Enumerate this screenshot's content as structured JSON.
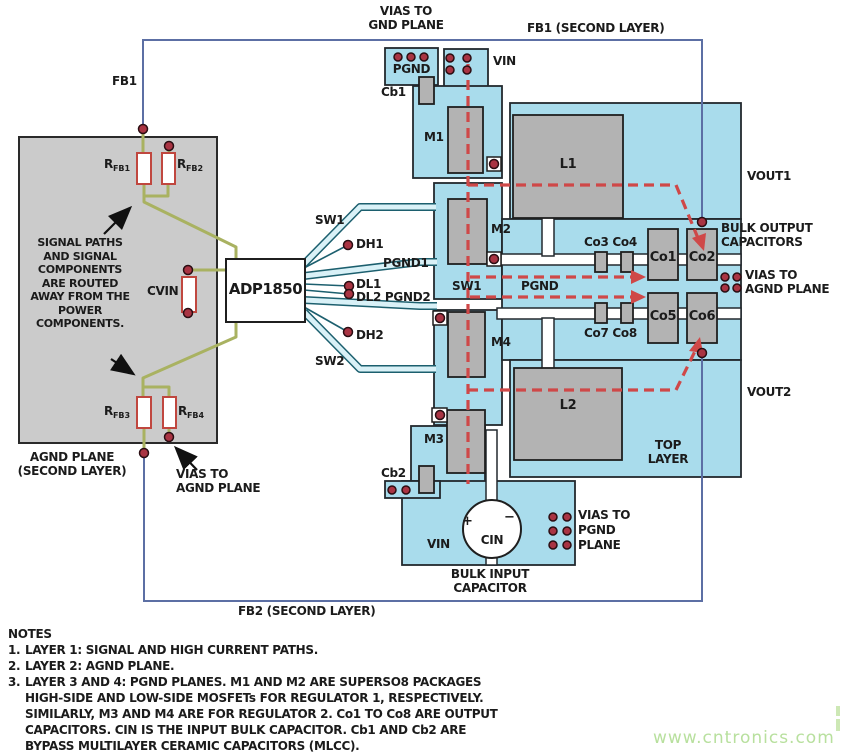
{
  "title": "ADP1850 dual buck regulator PCB layout diagram",
  "labels": {
    "vias_gnd_plane": [
      "VIAS TO",
      "GND PLANE"
    ],
    "fb1_second_layer": "FB1 (SECOND LAYER)",
    "fb1": "FB1",
    "vin_top": "VIN",
    "pgnd_pad": "PGND",
    "cb1": "Cb1",
    "m1": "M1",
    "m2": "M2",
    "m3": "M3",
    "m4": "M4",
    "l1": "L1",
    "l2": "L2",
    "sw1_pin": "SW1",
    "sw2_pin": "SW2",
    "dh1": "DH1",
    "pgnd1": "PGND1",
    "dl1": "DL1",
    "dl2_pgnd2": "DL2 PGND2",
    "dh2": "DH2",
    "chip": "ADP1850",
    "cvin": "CVIN",
    "signal_note": "SIGNAL PATHS AND SIGNAL COMPONENTS ARE ROUTED AWAY FROM THE POWER COMPONENTS.",
    "agnd_plane": [
      "AGND PLANE",
      "(SECOND LAYER)"
    ],
    "vias_agnd_left": [
      "VIAS TO",
      "AGND PLANE"
    ],
    "fb2_second_layer": "FB2 (SECOND LAYER)",
    "sw1_region": "SW1",
    "pgnd_region": "PGND",
    "co3co4": "Co3 Co4",
    "co7co8": "Co7 Co8",
    "co1": "Co1",
    "co2": "Co2",
    "co5": "Co5",
    "co6": "Co6",
    "bulk_output": [
      "BULK OUTPUT",
      "CAPACITORS"
    ],
    "vias_agnd_right": [
      "VIAS TO",
      "AGND PLANE"
    ],
    "vout1": "VOUT1",
    "vout2": "VOUT2",
    "top_layer": [
      "TOP",
      "LAYER"
    ],
    "vin_bottom": "VIN",
    "cin": "CIN",
    "cin_plus": "+",
    "cin_minus": "−",
    "bulk_input": [
      "BULK INPUT",
      "CAPACITOR"
    ],
    "vias_pgnd_plane": [
      "VIAS TO",
      "PGND",
      "PLANE"
    ],
    "cb2": "Cb2"
  },
  "resistors": {
    "rfb1": {
      "main": "R",
      "sub": "FB1"
    },
    "rfb2": {
      "main": "R",
      "sub": "FB2"
    },
    "rfb3": {
      "main": "R",
      "sub": "FB3"
    },
    "rfb4": {
      "main": "R",
      "sub": "FB4"
    }
  },
  "notes": {
    "title": "NOTES",
    "items": [
      {
        "num": "1.",
        "text": "LAYER 1: SIGNAL AND HIGH CURRENT PATHS."
      },
      {
        "num": "2.",
        "text": "LAYER 2: AGND PLANE."
      },
      {
        "num": "3.",
        "text": "LAYER 3 AND 4: PGND PLANES. M1 AND M2 ARE SUPERSO8 PACKAGES HIGH-SIDE AND LOW-SIDE MOSFETs FOR REGULATOR 1, RESPECTIVELY. SIMILARLY, M3 AND M4 ARE FOR REGULATOR 2. Co1 TO Co8 ARE OUTPUT CAPACITORS. CIN IS THE INPUT BULK CAPACITOR. Cb1 AND Cb2 ARE BYPASS MULTILAYER CERAMIC CAPACITORS (MLCC)."
      }
    ]
  },
  "watermark": "www.cntronics.com",
  "colors": {
    "board_copper": "#a9dcec",
    "component_gray": "#b3b3b3",
    "signal_trace_olive": "#a9b261",
    "feedback_trace_blue": "#5c6fa4",
    "current_path_red": "#cf4848",
    "via_red": "#a93443",
    "resistor_outline": "#c0473f",
    "watermark_green": "#b8e09e"
  }
}
